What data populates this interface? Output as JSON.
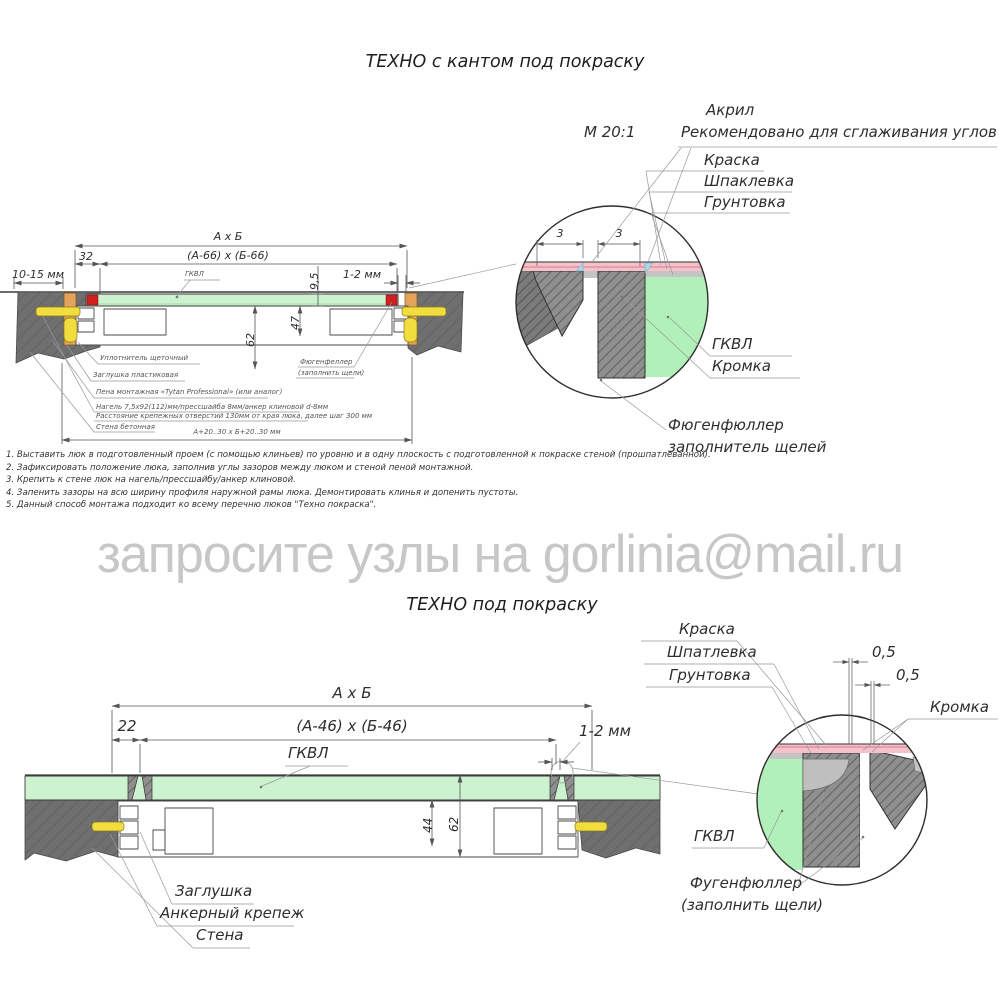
{
  "watermark": "запросите узлы на gorlinia@mail.ru",
  "top": {
    "title": "ТЕХНО с кантом под покраску",
    "scale": "М 20:1",
    "callouts": {
      "akril": "Акрил",
      "akril_note": "Рекомендовано для сглаживания углов",
      "kraska": "Краска",
      "shpaklevka": "Шпаклевка",
      "gruntovka": "Грунтовка"
    },
    "detail": {
      "dim_left": "3",
      "dim_right": "3",
      "gkvl": "ГКВЛ",
      "kromka": "Кромка",
      "fugen_line1": "Фюгенфюллер",
      "fugen_line2": "заполнитель щелей"
    },
    "draw": {
      "dim_axb": "А х Б",
      "dim_inner": "(А-66) х (Б-66)",
      "dim_32": "32",
      "dim_wall": "10-15 мм",
      "dim_gap": "1-2 мм",
      "gkvl": "ГКВЛ",
      "dim_95": "9,5",
      "dim_62": "62",
      "dim_47": "47",
      "note_uplotnitel": "Уплотнитель щеточный",
      "note_zaglushka": "Заглушка пластиковая",
      "note_pena": "Пена монтажная «Tytan Professional» (или аналог)",
      "note_nagel1": "Нагель 7,5х92(112)мм/прессшайба 8мм/анкер клиновой d-8мм",
      "note_nagel2": "Расстояние крепежных отверстий 130мм от края люка, далее шаг 300 мм",
      "note_stena": "Стена бетонная",
      "note_fugen1": "Фюгенфеллер",
      "note_fugen2": "(заполнить щели)",
      "dim_bottom": "А+20..30 х Б+20..30 мм"
    }
  },
  "instructions": [
    "1. Выставить люк в подготовленный проем (с помощью клиньев) по уровню и в одну плоскость с подготовленной к покраске стеной (прошпатлеванной).",
    "2. Зафиксировать положение люка, заполнив углы зазоров между люком и стеной пеной монтажной.",
    "3. Крепить к стене люк на нагель/прессшайбу/анкер клиновой.",
    "4. Запенить зазоры на всю ширину профиля наружной рамы люка. Демонтировать клинья и допенить пустоты.",
    "5. Данный способ монтажа подходит ко всему перечню люков \"Техно покраска\"."
  ],
  "bottom": {
    "title": "ТЕХНО под покраску",
    "callouts": {
      "kraska": "Краска",
      "shpatlevka": "Шпатлевка",
      "gruntovka": "Грунтовка",
      "dim05a": "0,5",
      "dim05b": "0,5",
      "kromka": "Кромка",
      "gkvl": "ГКВЛ",
      "fugen1": "Фугенфюллер",
      "fugen2": "(заполнить щели)"
    },
    "draw": {
      "dim_axb": "А х Б",
      "dim_inner": "(А-46) х (Б-46)",
      "dim_22": "22",
      "dim_gap": "1-2 мм",
      "gkvl": "ГКВЛ",
      "dim_44": "44",
      "dim_62": "62",
      "zaglushka": "Заглушка",
      "anker": "Анкерный крепеж",
      "stena": "Стена"
    }
  },
  "colors": {
    "gkvl_green": "#cdf2cf",
    "detail_green": "#b2f0ba",
    "paint_pink": "#f5c2cb",
    "acrylic_blue": "#a6d9ea",
    "wall_gray": "#6f6f6f",
    "wood_orange": "#e4a35b",
    "anchor_yellow": "#f1de3e",
    "seal_red": "#cf1f1f"
  }
}
